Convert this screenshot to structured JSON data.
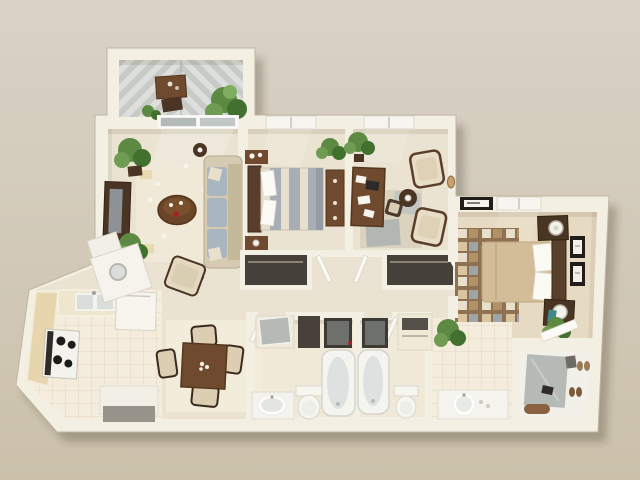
{
  "scene": {
    "kind": "3d-rendered-apartment-floor-plan",
    "visible_text": "",
    "view": "top-down isometric dollhouse view on plain tan backdrop"
  },
  "colors": {
    "bg_top": "#d9d2c6",
    "bg_bottom": "#cbc1ab",
    "wall": "#f3efe2",
    "wall_edge": "#d8d1bd",
    "carpet": "#eae3d1",
    "bath_floor": "#f0e9d8",
    "tile": "#f4eddd",
    "tile_line": "#e3d8c0",
    "deck_a": "#c7cac6",
    "deck_b": "#dddfdc",
    "white_fix": "#f6f5f0",
    "gray_fix": "#d9dddc",
    "wood": "#6f4a2e",
    "wood_dark": "#4a3424",
    "wood_mid": "#8a6a4b",
    "green": "#5d8a42",
    "green_dark": "#41702f",
    "couch": "#d6cbb2",
    "cushion": "#a9b6c0",
    "bed_gray": "#a9aeb6",
    "bed_cream": "#e7e0cd",
    "master_tan": "#d3bd98",
    "closet_dark": "#45403a",
    "appliance": "#3c3a35",
    "mirror": "#b6bab7",
    "frame_black": "#201d1a",
    "rug_brown": "#8a6a4b",
    "accent_red": "#a32525",
    "tv_gray": "#8d9296"
  },
  "rooms": [
    {
      "id": "balcony",
      "features": [
        "chevron-deck",
        "bistro-table",
        "fern-plant"
      ]
    },
    {
      "id": "living-room",
      "features": [
        "sofa",
        "armchair",
        "coffee-table",
        "tv-console",
        "area-rug",
        "potted-plants",
        "sliding-glass-door"
      ]
    },
    {
      "id": "dining-area",
      "features": [
        "dining-table",
        "four-chairs",
        "rug"
      ]
    },
    {
      "id": "kitchen",
      "features": [
        "stove",
        "double-sink",
        "refrigerator",
        "counters",
        "peninsula",
        "washer"
      ]
    },
    {
      "id": "bedroom-1",
      "features": [
        "striped-bed",
        "nightstands",
        "dresser",
        "window",
        "closet"
      ]
    },
    {
      "id": "bedroom-2-office",
      "features": [
        "desk",
        "desk-chair",
        "two-armchairs",
        "side-table",
        "rug",
        "window",
        "closet"
      ]
    },
    {
      "id": "master-bedroom",
      "features": [
        "bed",
        "checkered-rug",
        "nightstands-with-lamps",
        "framed-pictures",
        "wall-art",
        "window",
        "plant"
      ]
    },
    {
      "id": "hall-bathroom",
      "features": [
        "bathtub",
        "toilet",
        "sink-vanity",
        "closet"
      ]
    },
    {
      "id": "master-bathroom",
      "features": [
        "bathtub",
        "toilet",
        "vanity",
        "linen-closet"
      ]
    },
    {
      "id": "walk-in-closet",
      "features": [
        "mirror",
        "shoes",
        "bag",
        "open-door"
      ]
    }
  ]
}
